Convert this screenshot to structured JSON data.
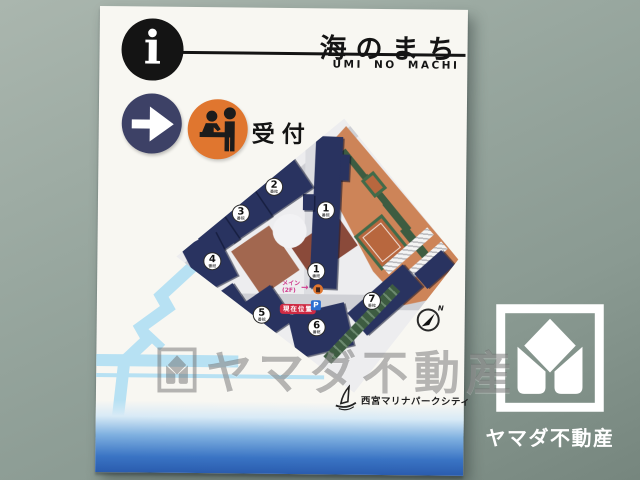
{
  "header": {
    "info_symbol": "i",
    "title": "海のまち",
    "subtitle": "UMI NO MACHI"
  },
  "legend": {
    "reception_label": "受付"
  },
  "map": {
    "markers": [
      {
        "num": "1",
        "sub": "番館"
      },
      {
        "num": "2",
        "sub": "番館"
      },
      {
        "num": "3",
        "sub": "番館"
      },
      {
        "num": "4",
        "sub": "番館"
      },
      {
        "num": "5",
        "sub": "番館"
      },
      {
        "num": "6",
        "sub": "番館"
      },
      {
        "num": "7",
        "sub": "番館"
      },
      {
        "num": "1",
        "sub": "番館"
      }
    ],
    "current_location_label": "現在位置",
    "main_entrance_line1": "メイン",
    "main_entrance_line2": "(2F)",
    "entrance_arrow": "→",
    "parking_symbol": "P",
    "north_label": "N",
    "developer_name": "西宮マリナパークシティ"
  },
  "watermark": {
    "text": "ヤマダ不動産"
  },
  "wall_logo": {
    "text": "ヤマダ不動産"
  },
  "colors": {
    "header_black": "#141414",
    "arrow_circle_navy": "#3d4166",
    "reception_orange": "#e0762f",
    "building_navy": "#293360",
    "park_orange": "#cd8458",
    "court_clay": "#b8673e",
    "tree_green": "#3d5c41",
    "location_red": "#cf2b44",
    "entrance_magenta": "#d13a8e",
    "parking_blue": "#2d6fd1",
    "water_blue": "#b7e1f3",
    "ocean_blue": "#2a5cae",
    "wall_green": "#8d9c94"
  }
}
